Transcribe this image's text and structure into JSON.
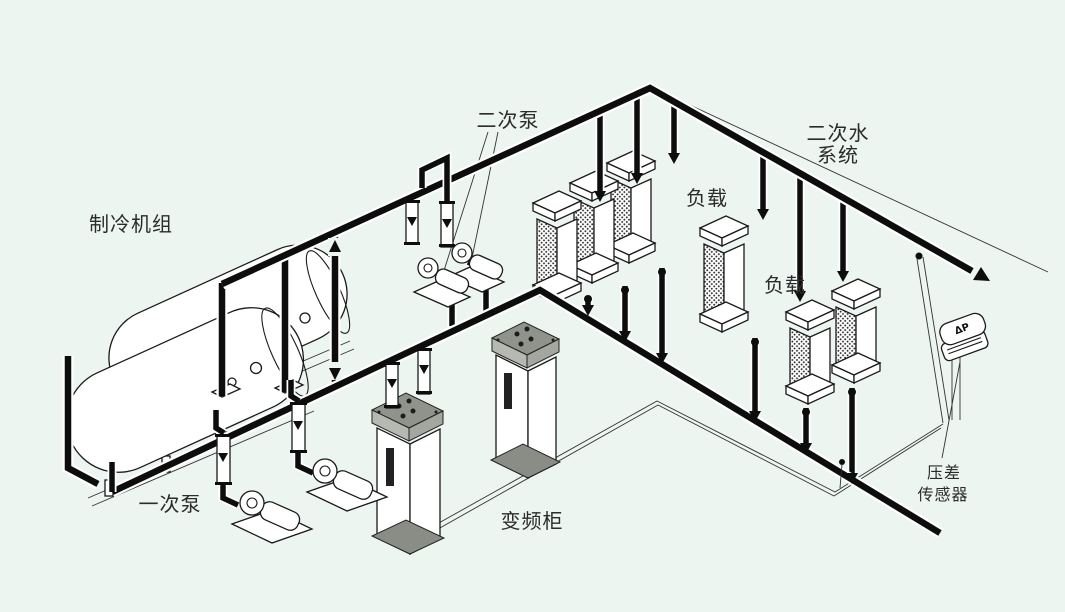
{
  "colors": {
    "background": "#edf5f0",
    "pipe": "#0d0d0d",
    "line": "#1a1a1a",
    "cabinet_top": "#8f938c",
    "cabinet_face_left": "#b6b9b1",
    "cabinet_face_right": "#a3a79f",
    "cabinet_base": "#8a8d86"
  },
  "labels": {
    "chiller_unit": "制冷机组",
    "primary_pump": "一次泵",
    "secondary_pump": "二次泵",
    "vfd_cabinet": "变频柜",
    "load_group_1": "负载",
    "load_group_2": "负载",
    "secondary_water_system_line1": "二次水",
    "secondary_water_system_line2": "系统",
    "dp_sensor_name_line1": "压差",
    "dp_sensor_name_line2": "传感器",
    "dp_sensor_device": "ΔP"
  }
}
